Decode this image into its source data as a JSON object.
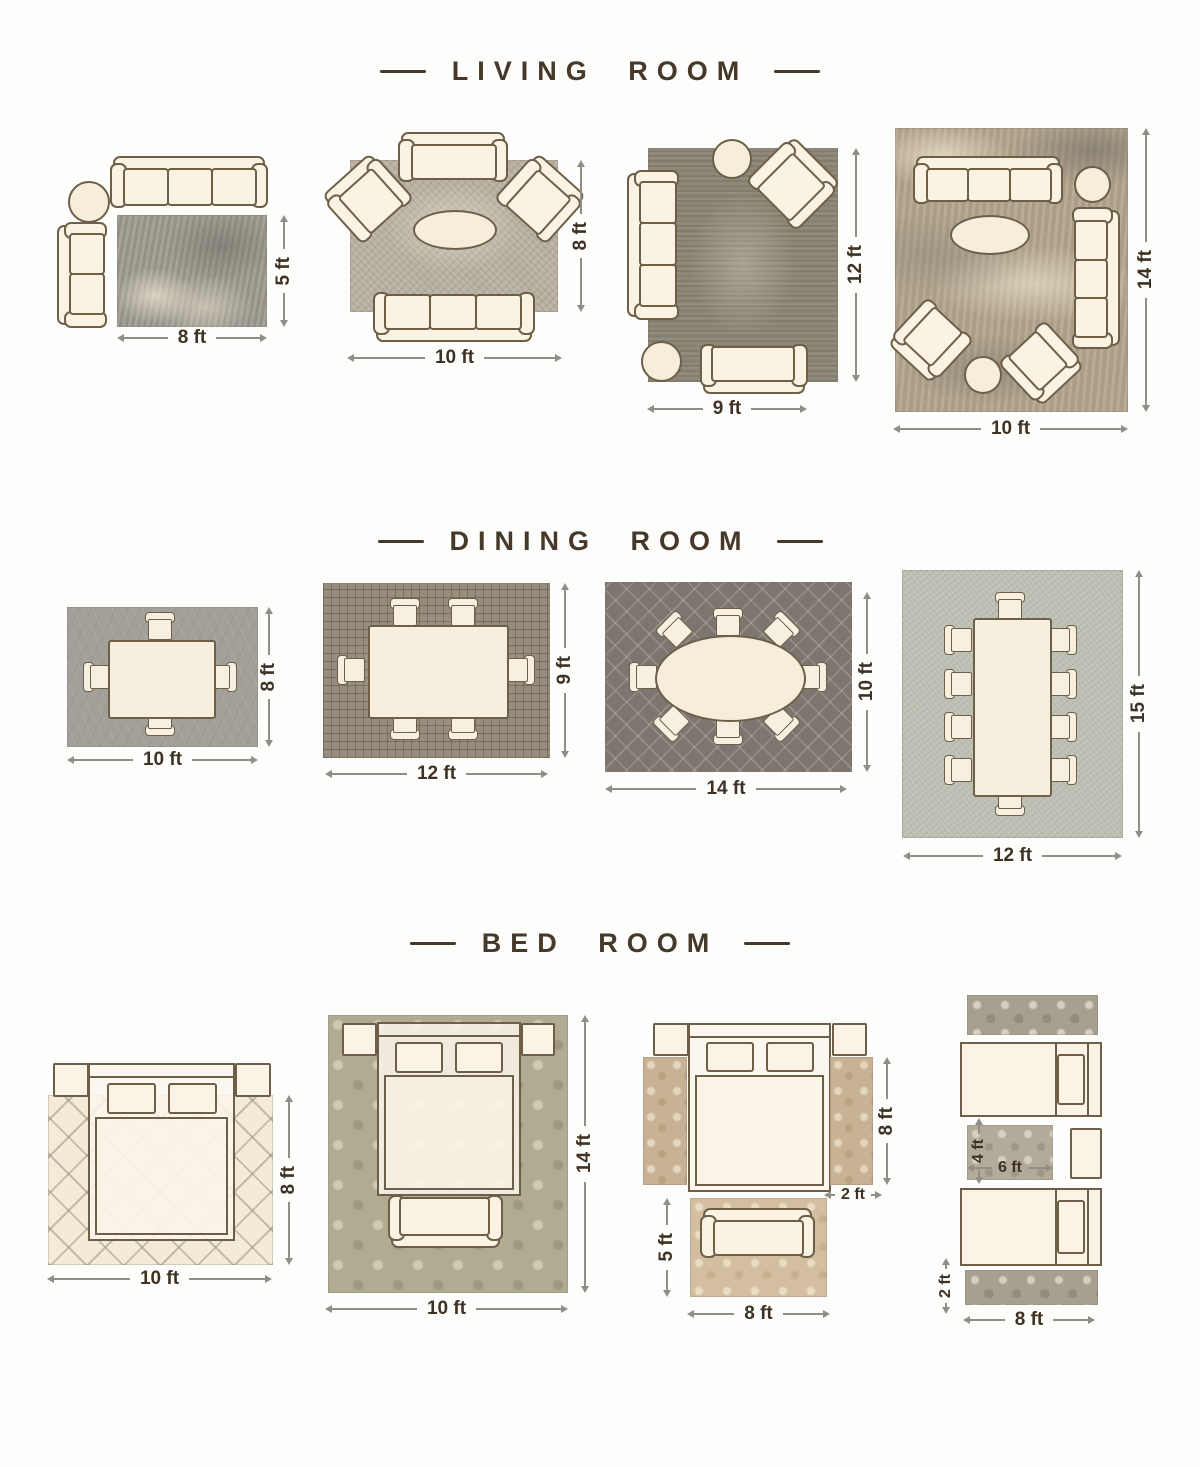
{
  "page": {
    "background": "#fdfdfb"
  },
  "colors": {
    "accent_brown": "#46392a",
    "furniture_outline": "#6d5f48",
    "furniture_fill": "#faf2e3",
    "dim_line": "#8f8f88",
    "dim_text": "#3e3225"
  },
  "sections": {
    "living": {
      "title": "LIVING ROOM",
      "layouts": [
        {
          "width": "8 ft",
          "height": "5 ft"
        },
        {
          "width": "10 ft",
          "height": "8 ft"
        },
        {
          "width": "9 ft",
          "height": "12 ft"
        },
        {
          "width": "10 ft",
          "height": "14 ft"
        }
      ]
    },
    "dining": {
      "title": "DINING ROOM",
      "layouts": [
        {
          "width": "10 ft",
          "height": "8 ft"
        },
        {
          "width": "12 ft",
          "height": "9 ft"
        },
        {
          "width": "14 ft",
          "height": "10 ft"
        },
        {
          "width": "12 ft",
          "height": "15 ft"
        }
      ]
    },
    "bedroom": {
      "title": "BED ROOM",
      "layouts": [
        {
          "width": "10 ft",
          "height": "8 ft"
        },
        {
          "width": "10 ft",
          "height": "14 ft"
        },
        {
          "runner_height": "8 ft",
          "runner_width": "2 ft",
          "accent_rug_height": "5 ft",
          "accent_rug_width": "8 ft"
        },
        {
          "center_rug_height": "4 ft",
          "center_rug_width": "6 ft",
          "runner_height": "2 ft",
          "runner_width": "8 ft"
        }
      ]
    }
  }
}
